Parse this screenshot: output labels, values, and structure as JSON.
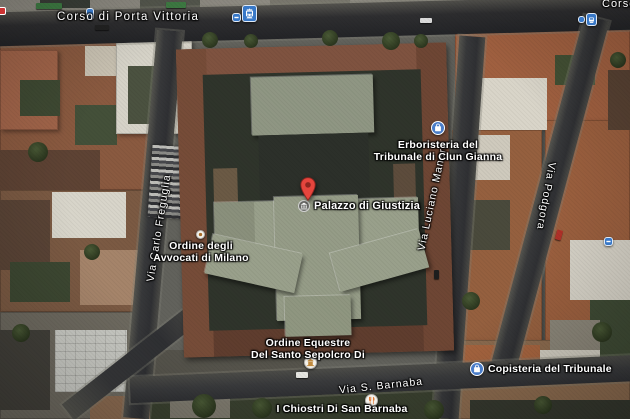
{
  "app": {
    "type": "google-maps-satellite-view"
  },
  "streets": {
    "corso": "Corso di Porta Vittoria",
    "corso_fragment": "Corso di Porta Vittoria",
    "freguglia": "Via Carlo Freguglia",
    "manara": "Via Luciano Manara",
    "podgora": "Via Podgora",
    "barnaba": "Via S. Barnaba"
  },
  "pois": {
    "palazzo": {
      "name": "Palazzo di Giustizia"
    },
    "erboristeria": {
      "line1": "Erboristeria del",
      "line2": "Tribunale di Clun Gianna"
    },
    "avvocati": {
      "line1": "Ordine degli",
      "line2": "Avvocati di Milano"
    },
    "equestre": {
      "line1": "Ordine Equestre",
      "line2": "Del Santo Sepolcro Di"
    },
    "copisteria": {
      "name": "Copisteria del Tribunale"
    },
    "chiostri": {
      "name": "I Chiostri Di San Barnaba"
    }
  },
  "icons": {
    "marker": "red-map-pin",
    "palazzo_badge": "courthouse-icon",
    "erboristeria_icon": "shopping-bag-icon",
    "copisteria_icon": "shopping-bag-icon",
    "equestre_icon": "place-of-worship-icon",
    "chiostri_icon": "restaurant-icon",
    "avvocati_icon": "poi-dot-icon",
    "transit_stops": "tram-stop-icon"
  },
  "colors": {
    "transit_blue": "#3878c7",
    "poi_blue": "#4a7dc9",
    "pin_red": "#e5453d",
    "pin_dark": "#8e2620",
    "label_text": "#ffffff",
    "street_dark": "#37383a",
    "roof_terracotta": "#9a5f41",
    "palazzo_gray": "#99a08b",
    "courtyard_dark": "#2e332a",
    "restaurant_orange": "#e07b39",
    "worship_amber": "#c08a3e"
  }
}
